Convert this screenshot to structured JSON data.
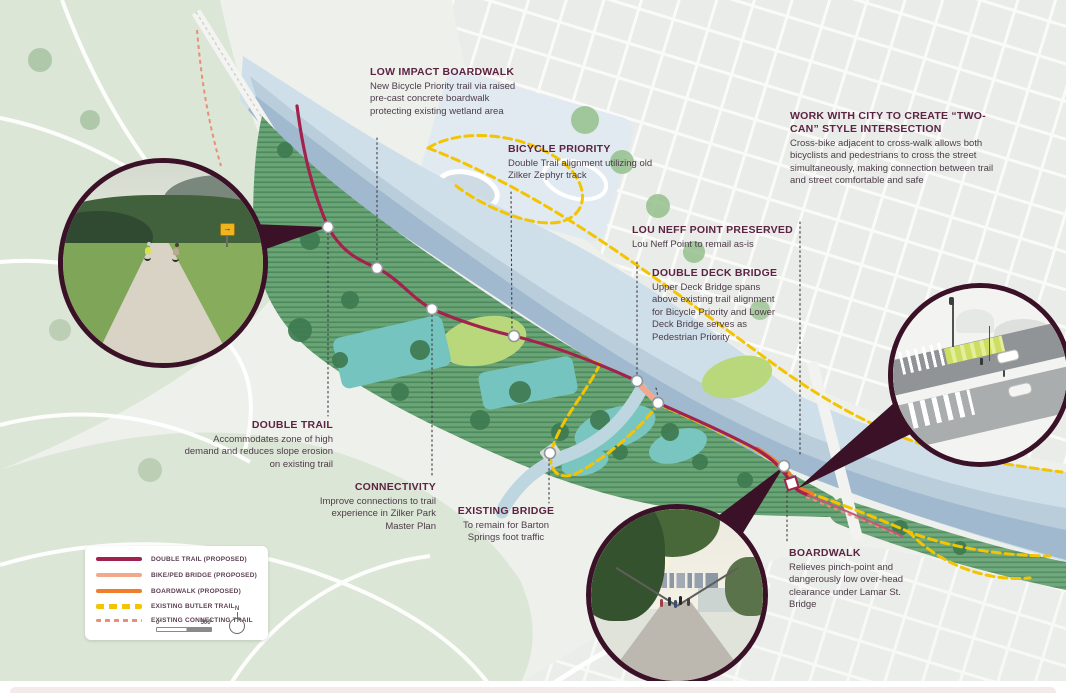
{
  "callouts": [
    {
      "id": "low-impact-boardwalk",
      "title": "LOW IMPACT BOARDWALK",
      "body": "New Bicycle Priority trail via raised pre-cast concrete boardwalk protecting existing wetland area"
    },
    {
      "id": "bicycle-priority",
      "title": "BICYCLE PRIORITY",
      "body": "Double Trail alignment utilizing old Zilker Zephyr track"
    },
    {
      "id": "two-can-intersection",
      "title": "WORK WITH CITY TO CREATE “TWO-CAN” STYLE INTERSECTION",
      "body": "Cross-bike adjacent to cross-walk allows both bicyclists and pedestrians to cross the street simultaneously, making connection between trail and street comfortable and safe"
    },
    {
      "id": "lou-neff-point",
      "title": "LOU NEFF POINT PRESERVED",
      "body": "Lou Neff Point to remail as-is"
    },
    {
      "id": "double-deck-bridge",
      "title": "DOUBLE DECK BRIDGE",
      "body": "Upper Deck Bridge spans above existing trail alignment for Bicycle Priority and Lower Deck Bridge serves as Pedestrian Priority"
    },
    {
      "id": "double-trail",
      "title": "DOUBLE TRAIL",
      "body": "Accommodates zone of high demand and reduces slope erosion on existing trail"
    },
    {
      "id": "connectivity",
      "title": "CONNECTIVITY",
      "body": "Improve connections to trail experience in Zilker Park Master Plan"
    },
    {
      "id": "existing-bridge",
      "title": "EXISTING BRIDGE",
      "body": "To remain for Barton Springs foot traffic"
    },
    {
      "id": "boardwalk",
      "title": "BOARDWALK",
      "body": "Relieves pinch-point and dangerously low over-head clearance under Lamar St. Bridge"
    }
  ],
  "legend": {
    "items": [
      {
        "label": "DOUBLE TRAIL (PROPOSED)",
        "swatch": "double-trail-proposed-line"
      },
      {
        "label": "BIKE/PED BRIDGE (PROPOSED)",
        "swatch": "bike-ped-bridge-proposed-line"
      },
      {
        "label": "BOARDWALK (PROPOSED)",
        "swatch": "boardwalk-proposed-line"
      },
      {
        "label": "EXISTING BUTLER TRAIL",
        "swatch": "existing-butler-trail-dashes"
      },
      {
        "label": "EXISTING CONNECTING TRAIL",
        "swatch": "existing-connecting-trail-dashes"
      }
    ],
    "scale": {
      "start": "0'",
      "end": "500'"
    },
    "north_label": "N"
  },
  "colors": {
    "double_trail": "#a2224f",
    "bike_ped_bridge": "#f2a98b",
    "boardwalk": "#ee7d2c",
    "existing_butler_trail": "#f3c402",
    "existing_connecting_trail": "#e98e77",
    "callout_heading": "#5d2342",
    "callout_body": "#4d3c49",
    "river": "#cfdfe9",
    "park_green": "#68a273",
    "pointer_wedge": "#3a1126"
  }
}
